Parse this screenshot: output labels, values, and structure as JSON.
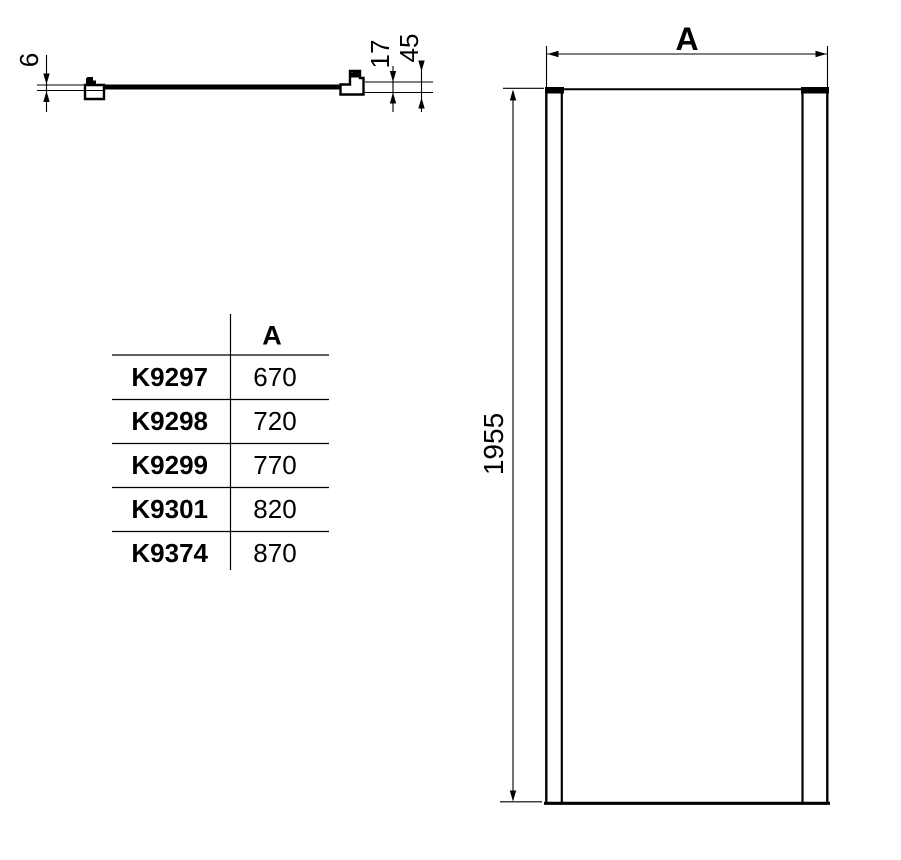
{
  "section_view": {
    "glass_thickness": "6",
    "profile_dim_inner": "17",
    "profile_dim_outer": "45"
  },
  "front_view": {
    "width_label": "A",
    "height_dim": "1955"
  },
  "size_table": {
    "header_a": "A",
    "rows": [
      {
        "code": "K9297",
        "width": "670"
      },
      {
        "code": "K9298",
        "width": "720"
      },
      {
        "code": "K9299",
        "width": "770"
      },
      {
        "code": "K9301",
        "width": "820"
      },
      {
        "code": "K9374",
        "width": "870"
      }
    ]
  },
  "colors": {
    "line": "#000000",
    "background": "#ffffff"
  }
}
